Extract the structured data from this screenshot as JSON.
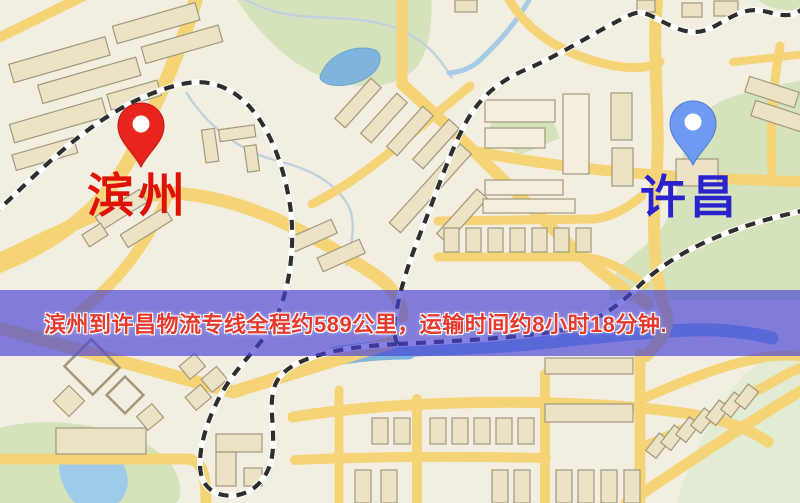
{
  "map": {
    "origin": {
      "label": "滨州",
      "marker_color": "#e8251c",
      "label_color": "#e01208"
    },
    "destination": {
      "label": "许昌",
      "marker_color": "#6e9af2",
      "label_color": "#2a23cc"
    },
    "banner": {
      "text": "滨州到许昌物流专线全程约589公里，运输时间约8小时18分钟.",
      "background": "rgba(70,66,212,0.66)",
      "text_color": "#e63a2e"
    },
    "style": {
      "background": "#f2eee2",
      "road": "#f5d478",
      "park": "#d5e3bd",
      "water": "#7fb4dc",
      "building": "#ece3c7",
      "railway": "#2e2e2e"
    }
  }
}
